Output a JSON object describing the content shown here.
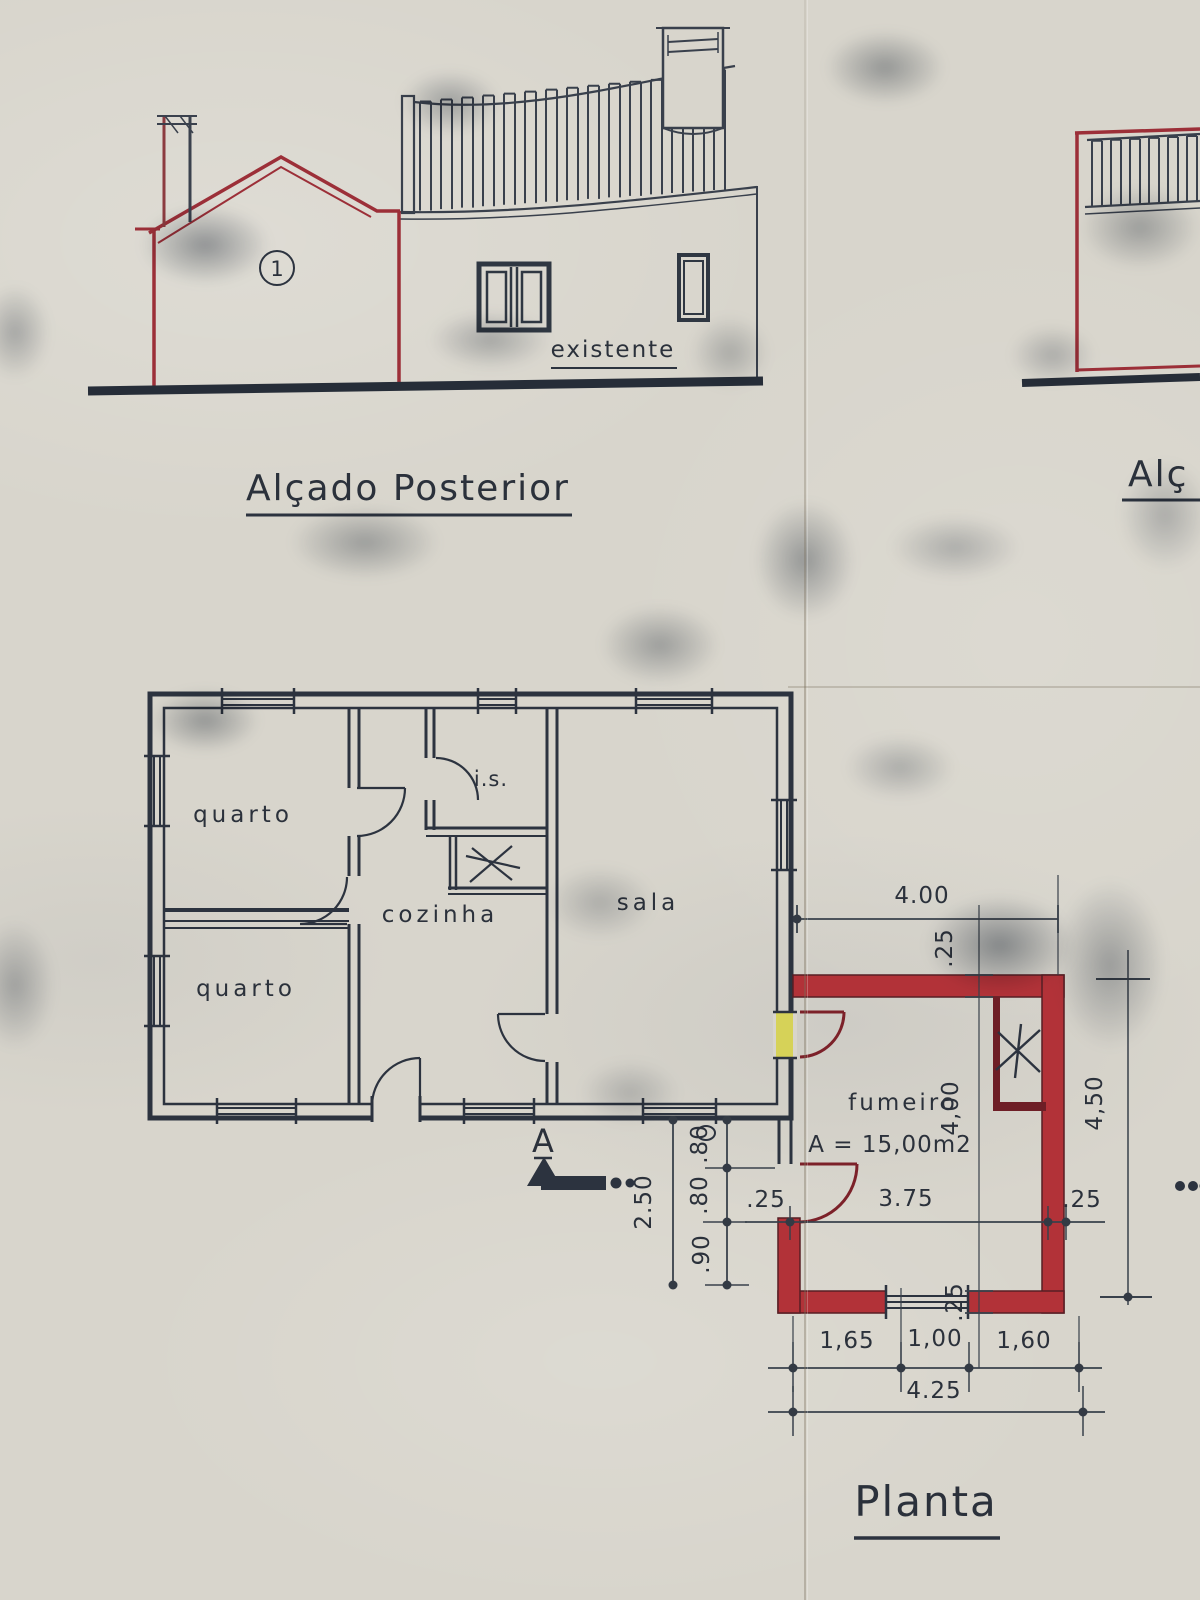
{
  "titles": {
    "rear_elevation": "Alçado Posterior",
    "side_elevation_partial": "Alç",
    "plan": "Planta"
  },
  "elevation": {
    "existing_label": "existente",
    "unit_marker": "1"
  },
  "plan_labels": {
    "bedroom_top": "quarto",
    "bedroom_bottom": "quarto",
    "kitchen": "cozinha",
    "bathroom": "i.s.",
    "living_room": "sala",
    "smokehouse": "fumeiro",
    "smokehouse_area": "A = 15,00m2",
    "section_letter": "A"
  },
  "dimensions": {
    "fumeiro_top_width": "4.00",
    "fumeiro_top_wall": ".25",
    "fumeiro_inner_height": "4,00",
    "fumeiro_outer_height": "4,50",
    "fumeiro_inner_width": "3.75",
    "fumeiro_left_wall": ".25",
    "fumeiro_right_wall": ".25",
    "fumeiro_bottom_wall": ".25",
    "bottom_seg_1": "1,65",
    "bottom_seg_2": "1,00",
    "bottom_seg_3": "1,60",
    "bottom_total": "4.25",
    "left_total": "2.50",
    "left_seg_1": ".80",
    "left_seg_2": ".80",
    "left_seg_3": ".90"
  },
  "colors": {
    "ink": "#2c333f",
    "new_work_red": "#9c2f38",
    "dark_red": "#7c2129",
    "highlight_yellow": "#d6d24b",
    "paper": "#d8d5cc"
  }
}
